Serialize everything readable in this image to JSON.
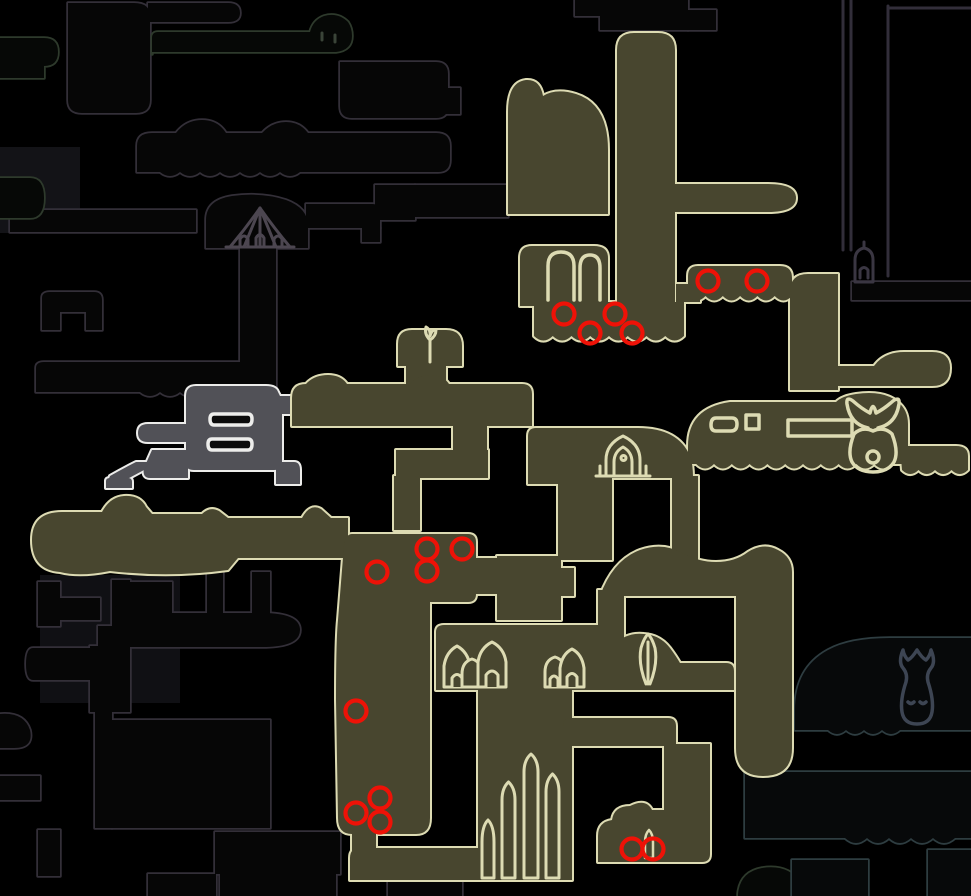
{
  "canvas": {
    "width": 971,
    "height": 896,
    "background": "#000000"
  },
  "colors": {
    "explored_fill": "#48462f",
    "explored_outline": "#dddbb3",
    "current_room_fill": "#515157",
    "current_room_outline": "#ececea",
    "unexplored_outline": "#332f38",
    "unexplored_green_outline": "#2e3a2c",
    "unexplored_teal_outline": "#2e3d41",
    "marker_red": "#ee1207",
    "fog_fill": "#111114"
  },
  "markers": {
    "name": "red-circle-marker",
    "color": "#ee1207",
    "radius": 10.5,
    "stroke_width": 4.2,
    "count": 16,
    "points": [
      [
        564,
        314
      ],
      [
        615,
        314
      ],
      [
        590,
        333
      ],
      [
        632,
        333
      ],
      [
        708,
        281
      ],
      [
        757,
        281
      ],
      [
        427,
        549
      ],
      [
        462,
        549
      ],
      [
        427,
        571
      ],
      [
        377,
        572
      ],
      [
        356,
        711
      ],
      [
        380,
        798
      ],
      [
        356,
        813
      ],
      [
        380,
        822
      ],
      [
        632,
        849
      ],
      [
        653,
        849
      ]
    ]
  },
  "fog_patches": [
    {
      "x": 0,
      "y": 147,
      "w": 80,
      "h": 86,
      "fill": "#131317"
    },
    {
      "x": 40,
      "y": 575,
      "w": 140,
      "h": 128,
      "fill": "#101014"
    }
  ],
  "layers": [
    {
      "name": "unexplored-rooms-gray",
      "stroke": "#332f38",
      "width": 3.5,
      "fill": "#060606",
      "two_pass": true,
      "shapes": [
        "M68,3 h66 Q150,3 150,16 V100 Q150,113 136,113 H82 Q68,113 68,100 Z",
        "M148,3 h80 Q240,3 240,13 Q240,22 228,22 H148 Z",
        "M340,62 h96 Q448,62 448,74 V106 Q448,118 436,118 H352 Q340,118 340,106 Z",
        "M436,88 h24 v26 h-24 Z",
        "M137,172 V146 Q137,133 152,133 H176 Q186,120 202,120 Q218,120 226,133 H262 Q272,122 286,122 Q300,122 308,133 H436 Q450,133 450,146 V160 Q450,172 438,172 H300 q-10,8 -20,0 q-10,8 -20,0 q-10,8 -20,0 q-10,8 -20,0 q-10,8 -20,0 q-10,8 -20,0 q-10,8 -20,0 Z",
        "M10,232 V216 Q10,210 16,210 H196 V232 Z",
        "M206,248 V220 Q206,200 232,196 Q262,192 286,200 Q308,208 308,226 V248 Z",
        "M306,204 h66 Q380,204 380,212 V228 H306 Z",
        "M362,228 h18 v14 h-18 Z",
        "M415,185 h93 v32 h-93 Z",
        "M375,185 h40 v35 h-40 Z",
        "M240,246 h36 v146 h-36 Z",
        "M36,392 V368 Q36,362 44,362 H240 V392 q-10,8 -20,0 q-10,8 -20,0 q-10,8 -20,0 q-10,8 -20,0 q-10,8 -20,0 Z",
        "M42,330 V298 Q42,292 50,292 H94 Q102,292 102,300 V330 H86 V312 H60 V330 Z",
        "M207,572 h16 v42 h-16 Z",
        "M252,572 h18 v62 h-18 Z",
        "M38,582 h22 v44 h-22 Z",
        "M60,598 h40 v22 h-40 Z",
        "M112,580 h18 v132 h-18 Z",
        "M130,582 h42 v42 h-42 Z",
        "M98,626 h74 v20 h-74 Z",
        "M90,646 h22 v66 h-22 Z",
        "M33,648 Q26,648 26,664 Q26,680 33,680 H90 V648 Z",
        "M114,647 V612 Q114,604 122,604 H132 V613 H262 Q300,613 300,630 Q300,647 262,647 Z",
        "M95,694 h17 v134 h-17 Z",
        "M112,720 h158 v108 h-158 Z",
        "M0,748 V714 Q24,712 30,730 Q34,748 14,748 Z",
        "M0,800 V776 h40 v24 Z",
        "M38,830 h22 v46 h-22 Z",
        "M215,832 H340 V874 H215 Z",
        "M220,872 h116 v24 h-116 Z",
        "M148,874 h68 v22 h-68 Z",
        "M388,882 h74 v14 h-74 Z",
        "M600,0 h88 v30 h-88 Z",
        "M688,10 h28 v20 h-28 Z",
        "M575,0 h25 v16 h-25 Z",
        "M852,282 H971 V300 H852 Z"
      ]
    },
    {
      "name": "unexplored-rooms-green",
      "stroke": "#2e3a2c",
      "width": 3.5,
      "fill": "#060806",
      "two_pass": true,
      "shapes": [
        "M152,54 V38 Q152,32 158,32 H310 Q313,20 324,16 Q338,12 348,22 Q352,28 352,36 Q352,50 336,52 H152 Z",
        "M0,38 h44 Q58,38 58,52 Q58,66 44,66 V78 H0 Z",
        "M0,218 V178 h30 Q44,178 44,198 Q44,218 30,218 Z",
        "M738,896 V894 Q740,872 762,868 Q788,864 800,882 Q806,890 806,896 Z"
      ]
    },
    {
      "name": "unexplored-rooms-teal",
      "stroke": "#2e3d41",
      "width": 3.5,
      "fill": "#07090a",
      "two_pass": true,
      "shapes": [
        "M795,730 V710 Q795,668 828,650 Q850,638 890,638 H971 V730 H900 q-9,8 -18,0 q-9,8 -18,0 q-9,8 -18,0 q-9,8 -18,0 Z",
        "M745,772 h226 v66 h-226 Z",
        "M845,838 q11,10 22,0 q11,10 22,0 q11,10 22,0 q11,10 22,0 q11,10 22,0 l0,-12 h-110 Z",
        "M928,850 h43 v46 h-43 Z",
        "M792,860 h76 v36 h-76 Z"
      ]
    },
    {
      "name": "shaft-lines",
      "stroke": "#322e3a",
      "width": 3,
      "fill": "none",
      "two_pass": false,
      "shapes": [
        "M843,0 V250",
        "M851,0 V250",
        "M888,6 V276",
        "M890,8 H971"
      ]
    },
    {
      "name": "current-room-white",
      "stroke": "#ececea",
      "width": 4,
      "fill": "#515157",
      "two_pass": true,
      "shapes": [
        "M186,464 V396 Q186,386 196,386 H266 Q276,386 278,392 L280,396 H294 V414 H282 V462 Q282,470 274,470 H194 Q186,470 186,464 Z",
        "M190,442 H148 Q138,442 138,433 Q138,424 148,424 H190 Z",
        "M150,478 Q142,478 144,468 L152,450 H188 V478 Z",
        "M144,470 L118,484 Q108,489 108,481 L110,476 Q124,468 136,462 L150,462 Z",
        "M106,488 V481 Q106,478 110,478 H128 Q132,478 132,482 V488 Z",
        "M276,484 V462 h18 Q300,462 300,470 V484 Z"
      ]
    },
    {
      "name": "explored-rooms",
      "stroke": "#dddbb3",
      "width": 4,
      "fill": "#48462f",
      "two_pass": true,
      "shapes": [
        "M617,306 V50 Q617,33 634,33 H658 Q675,33 675,50 V306 Z",
        "M508,214 V112 Q508,82 526,80 Q540,79 543,96 Q556,88 576,94 Q608,104 608,150 V214 Z",
        "M672,212 V184 H768 Q796,184 796,198 Q796,212 768,212 Z",
        "M520,306 V258 Q520,246 532,246 H594 Q608,246 608,258 V306 Z",
        "M534,302 H684 V336 q-9.4,9 -18.75,0 q-9.4,9 -18.75,0 q-9.4,9 -18.75,0 q-9.4,9 -18.75,0 q-9.4,9 -18.75,0 q-9.4,9 -18.75,0 q-9.4,9 -18.75,0 q-9.4,9 -18.75,0 Z",
        "M676,284 h24 v18 h-24 Z",
        "M688,298 V276 Q688,266 698,266 H780 Q792,266 792,278 V296 q-8.6,9 -17.3,0 q-8.6,9 -17.3,0 q-8.6,9 -17.3,0 q-8.6,9 -17.3,0 q-8.6,9 -17.3,0 q-8.6,9 -17.3,0 Z",
        "M790,390 V292 Q790,274 808,274 H838 V390 Z",
        "M830,386 V366 H874 Q884,352 904,352 H932 Q950,352 950,368 Q950,386 932,386 Z",
        "M688,464 V446 Q688,408 730,402 H836 Q842,396 856,394 Q884,390 898,402 Q908,410 908,424 V464 H892 q-8.9,9 -17.8,0 q-8.9,9 -17.8,0 q-8.9,9 -17.8,0 q-8.9,9 -17.8,0 q-8.9,9 -17.8,0 q-8.9,9 -17.8,0 q-8.9,9 -17.8,0 q-8.9,9 -17.8,0 q-8.9,9 -17.8,0 q-8.9,9 -17.8,0 q-8.9,9 -17.8,0 Z",
        "M900,446 H956 Q968,446 968,456 V470 q-8.2,8 -16.5,0 q-8.2,8 -16.5,0 q-8.2,8 -16.5,0 q-8.2,8 -16.5,0 Z",
        "M398,366 V344 Q398,330 412,330 H446 Q462,330 462,346 V366 Z",
        "M406,386 V364 Q406,358 413,358 H439 Q446,358 446,365 V386 Z",
        "M292,426 V398 Q292,384 306,384 Q314,375 328,375 Q341,375 347,384 H410 Q418,375 431,375 Q443,375 449,384 H522 Q532,384 532,394 V426 Z",
        "M453,424 h34 v30 h-34 Z",
        "M396,450 h92 v28 h-92 Z",
        "M394,476 h26 v54 h-26 Z",
        "M528,484 V436 Q528,428 536,428 H590 Q612,428 612,450 V484 Z",
        "M558,480 h54 v80 h-54 Z",
        "M576,478 V436 Q576,428 584,428 H638 Q678,428 690,456 Q693,464 693,478 Z",
        "M562,462 h16 v16 h-16 Z",
        "M672,476 h26 v84 h-26 Z",
        "M60,572 Q32,570 32,540 Q32,512 62,512 H102 Q110,497 124,496 Q140,495 146,507 L152,514 H202 Q210,506 219,511 L228,518 H302 Q310,503 321,509 L331,518 H348 V558 H238 L228,570 Q170,578 110,571 Q80,577 60,572 Z",
        "M600,596 Q613,560 640,550 Q663,542 682,553 Q699,562 716,562 Q735,562 748,552 Q764,542 778,550 Q792,557 792,572 V596 Z",
        "M736,594 h56 v154 q0,28 -29,28 q-27,0 -27,-28 Z",
        "M560,690 V670 Q560,663 568,663 H598 Q604,652 614,644 Q628,632 644,634 Q660,635 670,648 Q676,656 680,663 H726 Q734,663 734,671 V690 Z",
        "M436,690 V632 Q436,625 444,625 H598 Q606,625 606,633 V690 Z",
        "M478,686 h94 v194 h-94 Z",
        "M350,880 V858 Q350,848 360,848 H482 V880 Z",
        "M352,830 h24 v24 h-24 Z",
        "M352,534 Q346,534 344,545 L338,620 Q336,640 336,700 L338,818 Q338,834 352,834 H416 Q430,834 430,818 V602 H468 Q476,602 476,594 V542 Q476,534 468,534 Z",
        "M472,558 h30 v36 h-30 Z",
        "M497,556 h64 v64 h-64 Z",
        "M556,568 h18 v28 h-18 Z",
        "M598,590 h26 v72 h-26 Z",
        "M563,746 V726 Q563,718 571,718 H668 Q676,718 676,726 V746 Z",
        "M664,744 h46 v76 h-46 Z",
        "M598,862 V836 Q598,822 612,820 Q614,806 630,806 Q646,798 652,810 H702 Q710,810 710,818 V854 Q710,862 702,862 Z"
      ]
    }
  ],
  "icons": [
    {
      "name": "stag-station-tent-icon",
      "stroke": "#4c4650",
      "width": 3,
      "fill": "none",
      "paths": [
        "M260,208 Q246,228 230,247 H290 Q274,228 260,208 Z",
        "M260,208 L244,247 M260,208 L260,247 M260,208 L276,247",
        "M240,247 v-8 q4,-6 8,0 v8 M256,247 v-9 q4,-7 8,0 v9 M274,247 v-8 q4,-6 8,0 v8",
        "M226,247 H294"
      ]
    },
    {
      "name": "dome-eyes-icon",
      "stroke": "#3a4438",
      "width": 3,
      "fill": "none",
      "paths": [
        "M322,40 v-7 M335,42 v-7"
      ]
    },
    {
      "name": "gray-room-window-icons",
      "stroke": "#ededeb",
      "width": 3.5,
      "fill": "#0b0b0b",
      "paths": [
        "M214,414 h34 Q252,414 252,419 Q252,425 248,425 H214 Q210,425 210,419 Q210,414 214,414 Z",
        "M212,439 h36 Q252,439 252,444 Q252,450 248,450 H212 Q208,450 208,444 Q208,439 212,439 Z"
      ]
    },
    {
      "name": "temple-arch-window-icons",
      "stroke": "#dddbb3",
      "width": 3.5,
      "fill": "none",
      "paths": [
        "M548,300 V266 Q548,252 561,252 Q574,252 574,266 V300",
        "M580,300 V268 Q580,255 590,255 Q600,255 600,268 V300"
      ]
    },
    {
      "name": "black-egg-temple-window-icons",
      "stroke": "#dddbb3",
      "width": 3.5,
      "fill": "none",
      "paths": [
        "M716,418 h16 q5,0 5,6 q0,7 -6,7 h-15 q-5,0 -5,-6 q0,-7 5,-7 Z",
        "M746,415 h13 v14 h-13 Z",
        "M788,420 h64 v16 h-64 Z"
      ]
    },
    {
      "name": "hollow-knight-seal-icon",
      "stroke": "#dddbb3",
      "width": 3.5,
      "fill": "none",
      "paths": [
        "M868,428 Q850,424 847,404 Q846,396 853,401 Q862,409 870,413 Q873,400 876,413 Q884,409 893,401 Q900,396 899,404 Q896,424 878,428",
        "M854,434 Q847,452 852,462 Q858,472 873,472 Q888,472 894,462 Q899,452 892,434 Q884,426 873,431 Q862,426 854,434 Z",
        "M867,457 a6,6 0 1,0 12,0 a6,6 0 1,0 -12,0"
      ]
    },
    {
      "name": "shrine-icon",
      "stroke": "#dddbb3",
      "width": 3,
      "fill": "none",
      "paths": [
        "M606,476 V460 Q606,444 623,436 Q640,444 640,460 V476",
        "M614,476 V462 Q614,452 623,447 Q632,452 632,462 V476",
        "M621,458 a2.5,2.5 0 1,0 5,0 a2.5,2.5 0 1,0 -5,0",
        "M600,476 v-10 M646,476 v-10",
        "M596,476 h54"
      ]
    },
    {
      "name": "sprout-icon",
      "stroke": "#dddbb3",
      "width": 3,
      "fill": "none",
      "paths": [
        "M430,362 V340",
        "M430,340 Q424,334 426,327 Q431,330 430,336 Q432,329 436,330 Q436,336 430,340 Z"
      ]
    },
    {
      "name": "hut-icons",
      "stroke": "#dddbb3",
      "width": 3,
      "fill": "#48462f",
      "paths": [
        "M444,687 V666 Q446,652 457,646 Q468,652 470,666 V687 Z",
        "M462,687 V674 Q462,662 472,659 Q482,662 482,674 V687 Z",
        "M478,687 V662 Q480,648 492,642 Q504,648 506,662 V687 Z",
        "M545,687 V672 Q545,660 555,657 Q565,660 565,672 V687 Z",
        "M560,687 V668 Q562,654 572,649 Q582,654 584,668 V687 Z",
        "M452,687 v-9 q5,-7 10,0 v9 M486,687 v-12 q6,-8 12,0 v12 M550,687 v-8 q4,-6 8,0 v8 M567,687 v-10 q5,-7 10,0 v10"
      ]
    },
    {
      "name": "leaf-icon",
      "stroke": "#dddbb3",
      "width": 3,
      "fill": "none",
      "paths": [
        "M646,684 Q638,664 641,648 Q644,638 648,634 Q652,638 655,648 Q658,664 650,684",
        "M648,642 V684"
      ]
    },
    {
      "name": "spire-icons",
      "stroke": "#dddbb3",
      "width": 3,
      "fill": "#48462f",
      "paths": [
        "M482,878 V842 Q482,826 488,820 Q494,826 494,842 V878 Z",
        "M502,878 V800 Q502,788 508.5,782 Q515,788 515,800 V878 Z",
        "M524,878 V772 Q524,760 531,754 Q538,760 538,772 V878 Z",
        "M546,878 V792 Q546,780 552.5,774 Q559,780 559,792 V878 Z"
      ]
    },
    {
      "name": "small-spike-icon",
      "stroke": "#dddbb3",
      "width": 2.5,
      "fill": "none",
      "paths": [
        "M645,858 V842 Q645,834 649,830 Q653,834 653,842 V858 Z"
      ]
    },
    {
      "name": "fish-statue-icon",
      "stroke": "#3d4553",
      "width": 3.5,
      "fill": "none",
      "paths": [
        "M917,650 Q912,658 908,660 Q904,656 903,650 Q898,662 903,668 Q908,674 906,682 Q900,700 902,712 Q904,724 917,724 Q930,724 932,712 Q934,700 928,682 Q926,674 931,668 Q936,662 931,650 Q930,656 926,660 Q922,658 917,650 Z",
        "M908,702 q3,3 6,0 M920,702 q3,3 6,0"
      ]
    },
    {
      "name": "lantern-icon",
      "stroke": "#3a3642",
      "width": 3,
      "fill": "none",
      "paths": [
        "M855,282 V260 Q855,250 864,248 Q873,250 873,260 V282 Z",
        "M860,278 v-8 q4,-5 8,0 v8",
        "M864,248 v-6"
      ]
    }
  ]
}
